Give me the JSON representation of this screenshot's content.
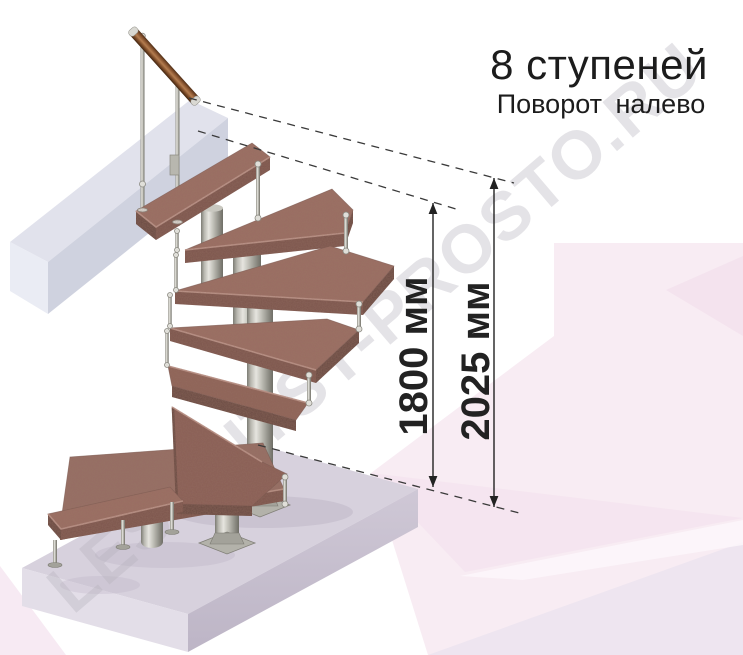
{
  "header": {
    "title": "8 ступеней",
    "subtitle": "Поворот налево"
  },
  "dimensions": {
    "to_top_step": "1800 мм",
    "total": "2025 мм"
  },
  "watermark": "LESTNITSY-PROSTO.RU",
  "illustration": {
    "steps_count": 8,
    "turn_direction": "налево",
    "colors": {
      "wood": "#9b6f65",
      "wood_dark_step": "#8a5f57",
      "wood_edge": "#7b554d",
      "wood_edge_end": "#684842",
      "metal": "#b0afa7",
      "floor_slab": "#d7d1dd",
      "slab_front": "#cbc4d4",
      "beam": "#e1e2ec",
      "background_pink": "#f8ecf3",
      "dimension_ink": "#222222",
      "title_ink": "#1c1c1c",
      "watermark_gray": "#b5b1bb"
    }
  }
}
